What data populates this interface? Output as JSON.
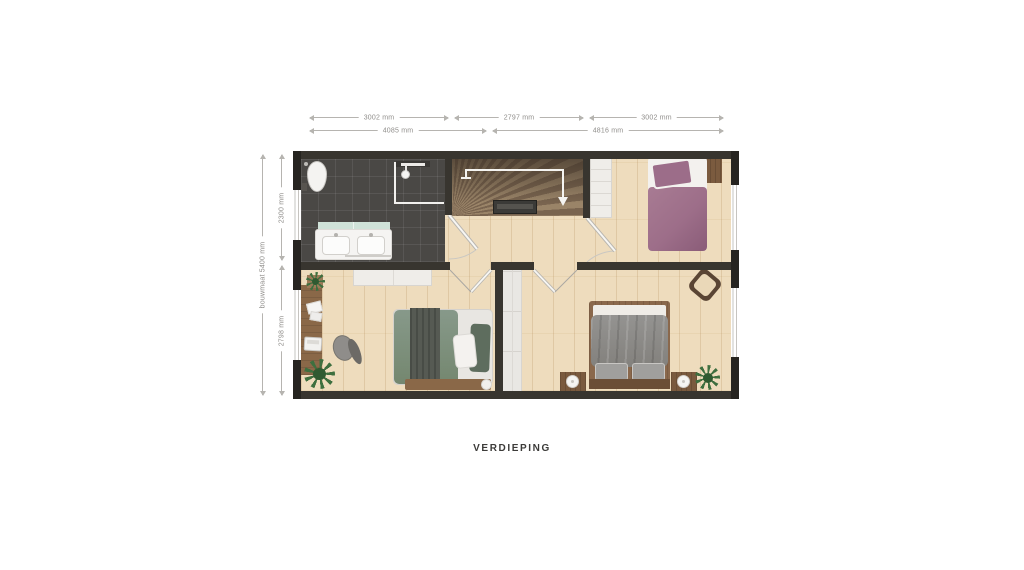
{
  "title": "VERDIEPING",
  "dims": {
    "top_inner": [
      "3002 mm",
      "2797 mm",
      "3002 mm"
    ],
    "top_outer": [
      "4085 mm",
      "4816 mm"
    ],
    "left_inner": [
      "2300 mm",
      "2798 mm"
    ],
    "left_outer": "bouwmaat 5400 mm"
  },
  "colors": {
    "wall": "#38352f",
    "wood_floor": "#eedcbd",
    "bathroom_tile": "#4a4845",
    "bed_purple": "#9d6e89",
    "bed_green": "#7e937f",
    "bed_gray": "#8b8a88",
    "vanity_mint": "#cfe2d8",
    "dimension_text": "#8f8d8a",
    "title_text": "#3c3b39"
  }
}
